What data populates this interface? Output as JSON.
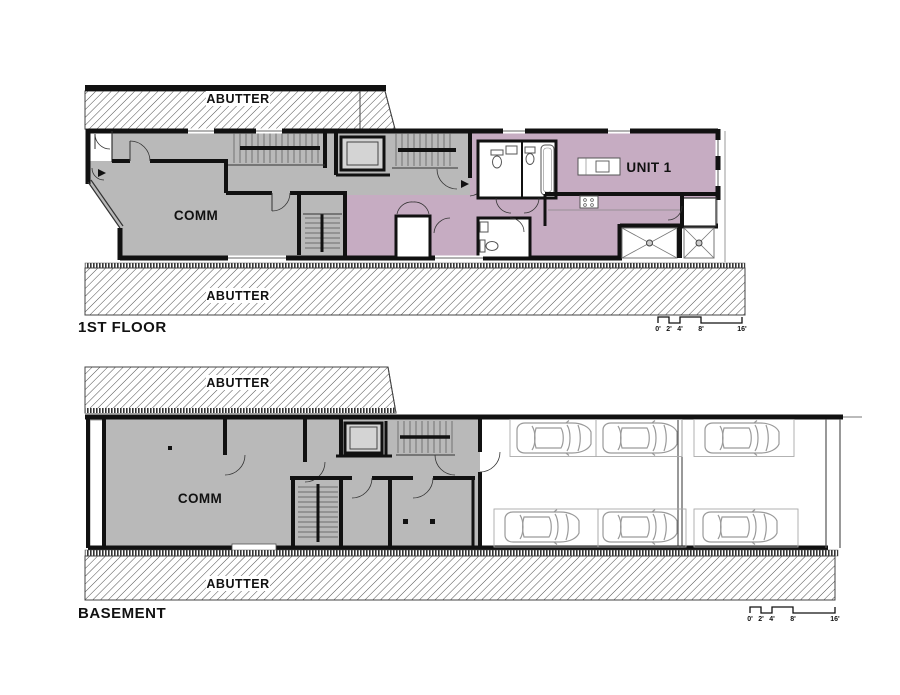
{
  "colors": {
    "background": "#ffffff",
    "common_area_fill": "#b9b9b9",
    "unit1_fill": "#c6acc2",
    "wall": "#111111",
    "elevator_fill": "#d4d4d4",
    "car_outline": "#9a9a9a"
  },
  "first_floor": {
    "title": "1ST FLOOR",
    "abutter_top_label": "ABUTTER",
    "abutter_bottom_label": "ABUTTER",
    "comm_label": "COMM",
    "unit_label": "UNIT 1",
    "scale_labels": [
      "0'",
      "2'",
      "4'",
      "8'",
      "16'"
    ]
  },
  "basement": {
    "title": "BASEMENT",
    "abutter_top_label": "ABUTTER",
    "abutter_bottom_label": "ABUTTER",
    "comm_label": "COMM",
    "parking_spaces": 6,
    "scale_labels": [
      "0'",
      "2'",
      "4'",
      "8'",
      "16'"
    ]
  }
}
